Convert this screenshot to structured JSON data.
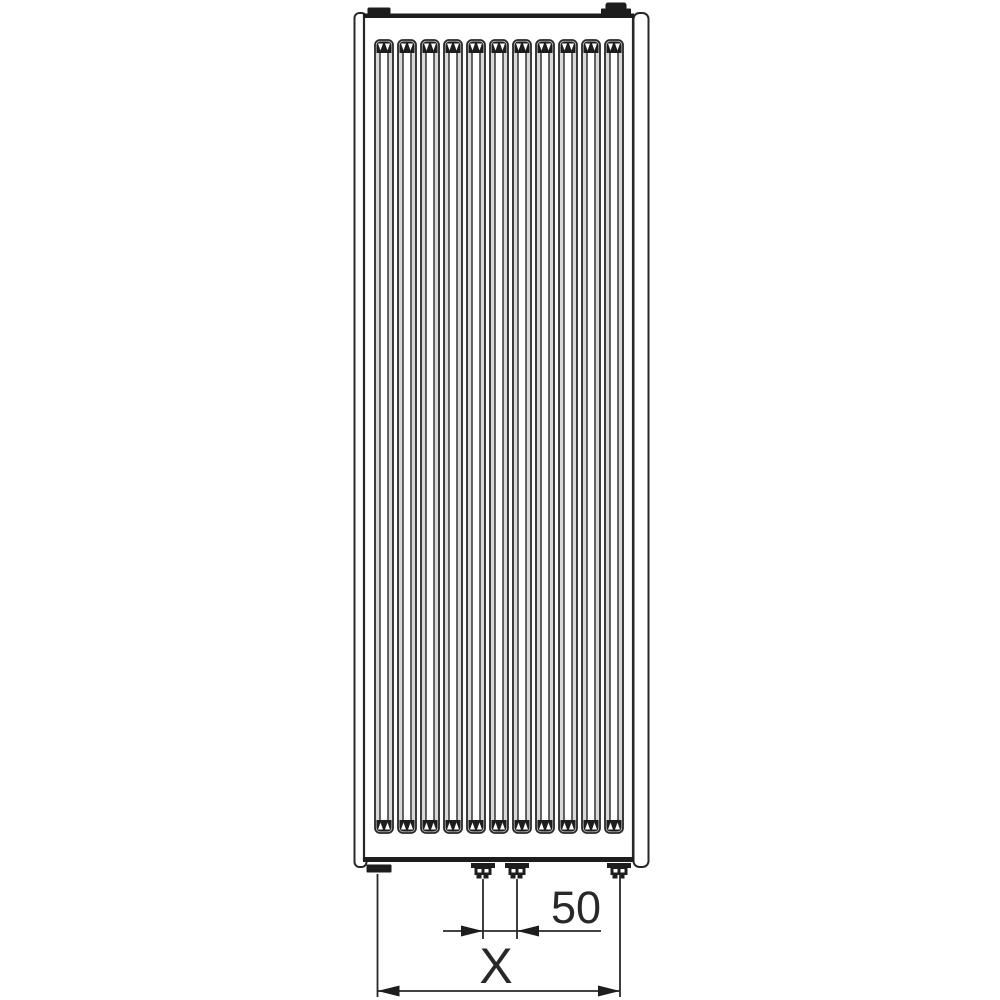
{
  "page": {
    "background": "#ffffff",
    "subject": "Vertical panel radiator, front view, technical drawing with bottom connection dimensions"
  },
  "drawing": {
    "type": "technical-diagram",
    "line_color": "#282828",
    "fill_color": "#1d1d1d",
    "shade_color": "#d9d9d9",
    "groove_count": 11,
    "groove": {
      "first_x": 375,
      "pitch": 23,
      "width": 18,
      "top_y": 40,
      "bottom_y": 833
    },
    "dimensions": {
      "nozzle_spacing": {
        "label": "50"
      },
      "overall_width": {
        "label": "X"
      }
    }
  }
}
